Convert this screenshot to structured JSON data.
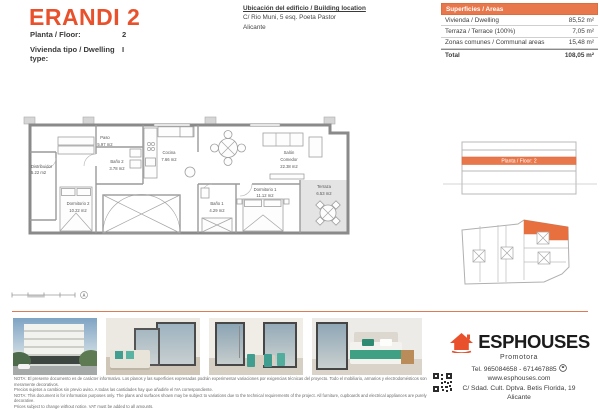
{
  "header": {
    "title": "ERANDI 2",
    "fields": [
      {
        "label": "Planta / Floor:",
        "value": "2"
      },
      {
        "label": "Vivienda tipo / Dwelling type:",
        "value": "I"
      }
    ],
    "location": {
      "title": "Ubicación del edificio / Building location",
      "line1": "C/ Rio Muni, 5 esq. Poeta Pastor",
      "line2": "Alicante"
    },
    "areas_table": {
      "header": "Superficies / Areas",
      "rows": [
        {
          "label": "Vivienda / Dwelling",
          "value": "85,52 m²"
        },
        {
          "label": "Terraza / Terrace (100%)",
          "value": "7,05 m²"
        },
        {
          "label": "Zonas comunes / Communal areas",
          "value": "15,48 m²"
        }
      ],
      "total_label": "Total",
      "total_value": "108,05 m²"
    }
  },
  "floor_plan": {
    "rooms": [
      {
        "id": "distribuidor",
        "lines": [
          "Distribuidor",
          "5.22 m2"
        ]
      },
      {
        "id": "paso",
        "lines": [
          "Paso",
          "5.97 m2"
        ]
      },
      {
        "id": "bano2",
        "lines": [
          "Baño 2",
          "3.78 m2"
        ]
      },
      {
        "id": "dormitorio2",
        "lines": [
          "Dormitorio 2",
          "10.22 m2"
        ]
      },
      {
        "id": "cocina",
        "lines": [
          "Cocina",
          "7.66 m2"
        ]
      },
      {
        "id": "salon",
        "lines": [
          "Salón",
          "Comedor",
          "22.38 m2"
        ]
      },
      {
        "id": "dormitorio1",
        "lines": [
          "Dormitorio 1",
          "11.12 m2"
        ]
      },
      {
        "id": "bano1",
        "lines": [
          "Baño 1",
          "4.29 m2"
        ]
      },
      {
        "id": "terraza",
        "lines": [
          "Terraza",
          "6.53 m2"
        ]
      }
    ]
  },
  "right_panel": {
    "elevation_label": "Planta / Floor: 2"
  },
  "footer": {
    "brand": {
      "name": "ESPHOUSES",
      "tagline": "Promotora"
    },
    "contact": {
      "phone": "Tel. 965084658 - 671467885",
      "web": "www.esphouses.com",
      "address": "C/ Sdad. Cult. Dptva. Betis Florida, 19",
      "city": "Alicante"
    },
    "disclaimer": [
      "NOTA: El presente documento es de carácter informativo. Los planos y las superficies expresadas podrán experimentar variaciones por exigencias técnicas del proyecto. Todo el mobiliario, armarios y electrodomésticos son meramente decorativos.",
      "Precios sujetos a cambios sin previo aviso. A todas las cantidades hay que añadirle el IVA correspondiente.",
      "NOTA: This document is for information purposes only. The plans and surfaces shown may be subject to variations due to the technical requirements of the project. All furniture, cupboards and electrical appliances are purely decorative.",
      "Prices subject to change without notice. VAT must be added to all amounts."
    ]
  },
  "colors": {
    "accent": "#e8512c",
    "table_header": "#e8784c",
    "highlight": "#e8784c",
    "rule": "#dd7b52"
  }
}
